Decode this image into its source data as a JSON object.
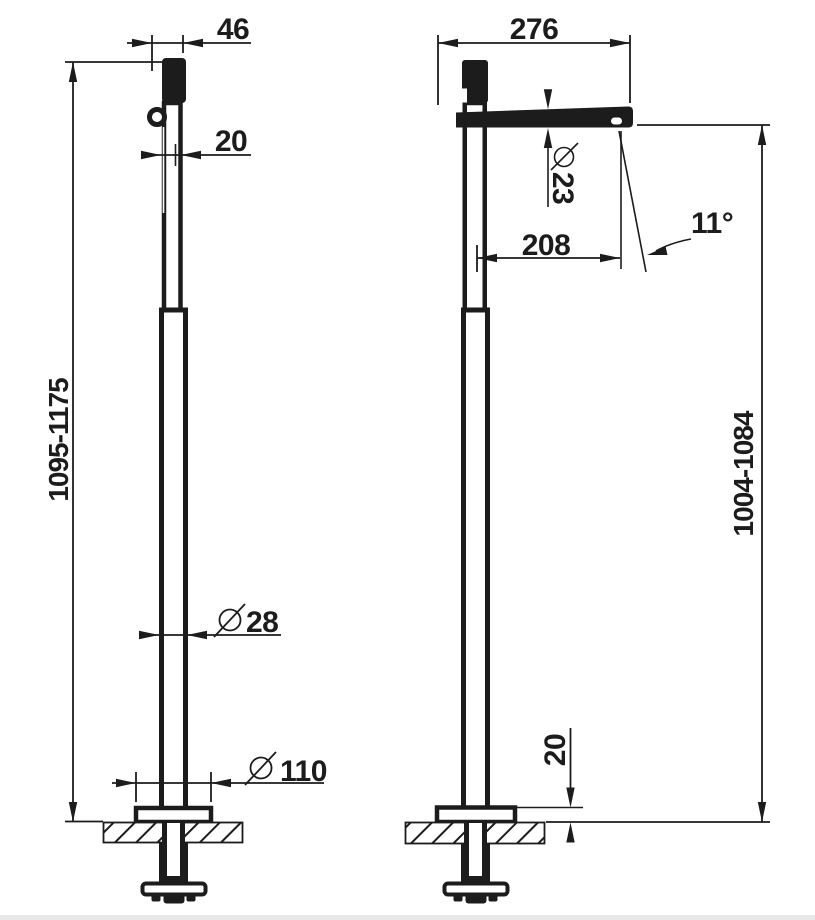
{
  "drawing": {
    "type": "technical-drawing",
    "subject": "freestanding floor-mounted faucet, two orthographic views",
    "ink_color": "#1c1c1c",
    "background_color": "#ffffff",
    "front_view": {
      "dim_handle_width": "46",
      "dim_upper_column_width": "20",
      "dim_height_range": "1095-1175",
      "dim_column_diameter": "28",
      "dim_base_plate_diameter": "110"
    },
    "side_view": {
      "dim_total_reach": "276",
      "dim_spout_diameter": "23",
      "dim_spout_projection": "208",
      "dim_spout_angle": "11°",
      "dim_height_range": "1004-1084",
      "dim_base_plate_height": "20"
    }
  }
}
